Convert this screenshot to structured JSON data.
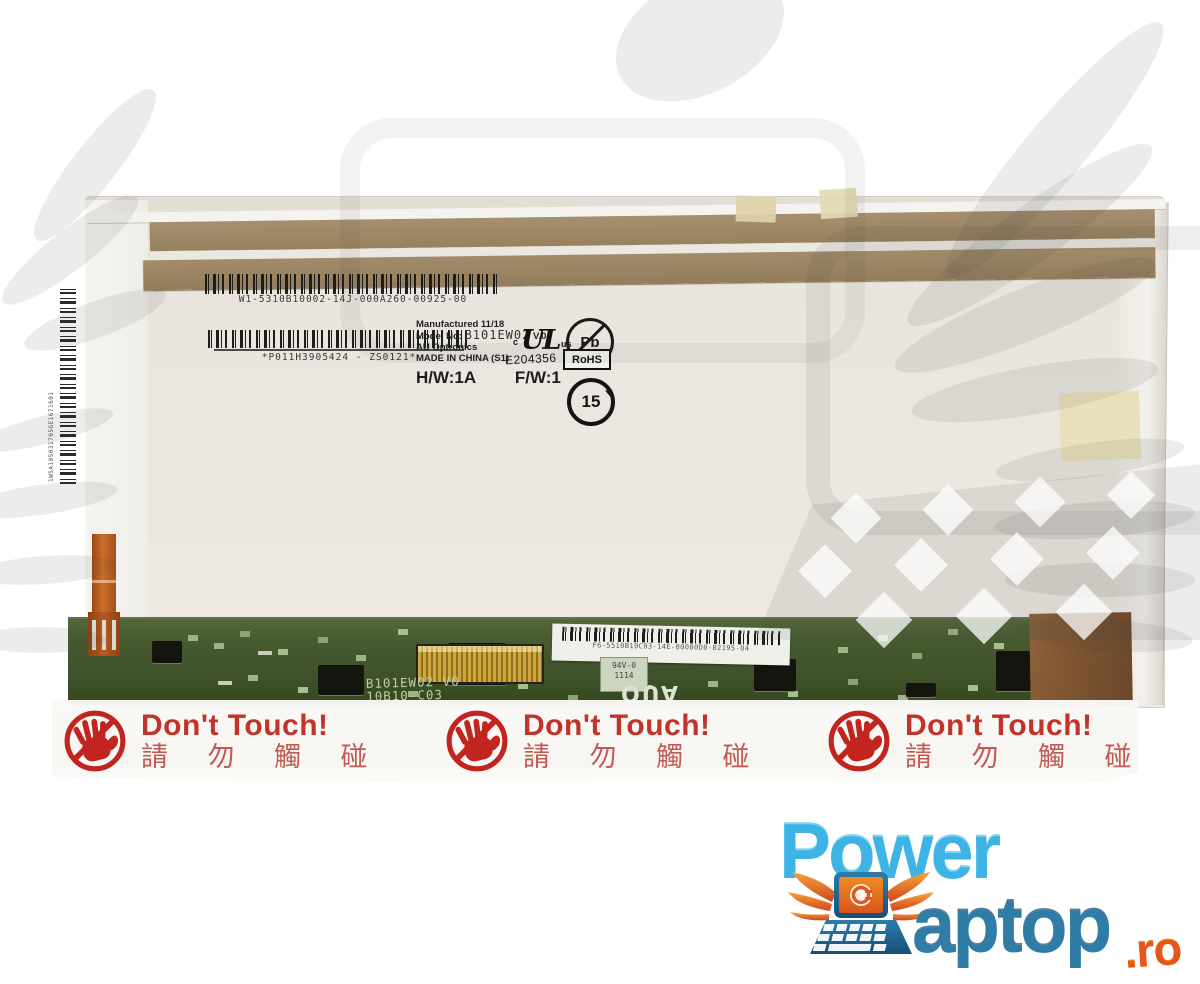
{
  "product_photo": {
    "description": "rear view of a laptop LCD screen replacement panel",
    "top_label": {
      "barcode_text": "W1-5310B10002-14J-000A260-00925-00"
    },
    "mid_label": {
      "barcode_text": "*P011H3905424 - ZS0121*"
    },
    "side_label": {
      "barcode_text": "1W5A105031705GE1671601"
    },
    "spec_label": {
      "manufactured": "Manufactured 11/18",
      "model_label": "Model No:",
      "model_value": "B101EW02",
      "model_version": "V.0",
      "maker": "AU Optronics",
      "origin": "MADE IN CHINA (S1)",
      "hw": "H/W:1A",
      "fw": "F/W:1"
    },
    "certifications": {
      "ul_letters": "UL",
      "ul_c": "c",
      "ul_us": "us",
      "ul_number": "E204356",
      "pb": "Pb",
      "rohs": "RoHS",
      "epup_years": "15"
    },
    "pcb": {
      "silkscreen_model": "B101EW02 V0",
      "silkscreen_code": "10B10-C03",
      "label_code": "F6-5510B10C03-14E-00000D0-02195-04",
      "flammability": "94V-0",
      "date_code": "1114",
      "maker_logo": "AUO"
    },
    "warning": {
      "title": "Don't Touch!",
      "subtitle": "請 勿 觸 碰"
    }
  },
  "brand": {
    "word1": "Power",
    "word2": "aptop",
    "tld": ".ro"
  },
  "icons": {
    "no_touch": "crossed-out-hand warning icon",
    "ul": "UL listed certification mark",
    "pb_free": "lead-free crossed Pb circle",
    "rohs": "RoHS compliance box",
    "epup": "China RoHS 15-year circle",
    "auo": "AU Optronics logo (printed upside-down)",
    "winged_laptop": "orange winged laptop brand emblem",
    "watermark": "gray winged-laptop shop watermark"
  },
  "colors": {
    "background": "#ffffff",
    "watermark_gray": "#e2e2e2",
    "panel_surface": "#ece8e1",
    "tape_bronze": "#9b8564",
    "pcb_green": "#46592f",
    "connector_gold": "#cda63e",
    "cable_orange": "#b85a20",
    "warning_red": "#c2332a",
    "brand_light_blue": "#3eb4e6",
    "brand_dark_blue": "#2f7da6",
    "brand_orange": "#e4571a"
  }
}
